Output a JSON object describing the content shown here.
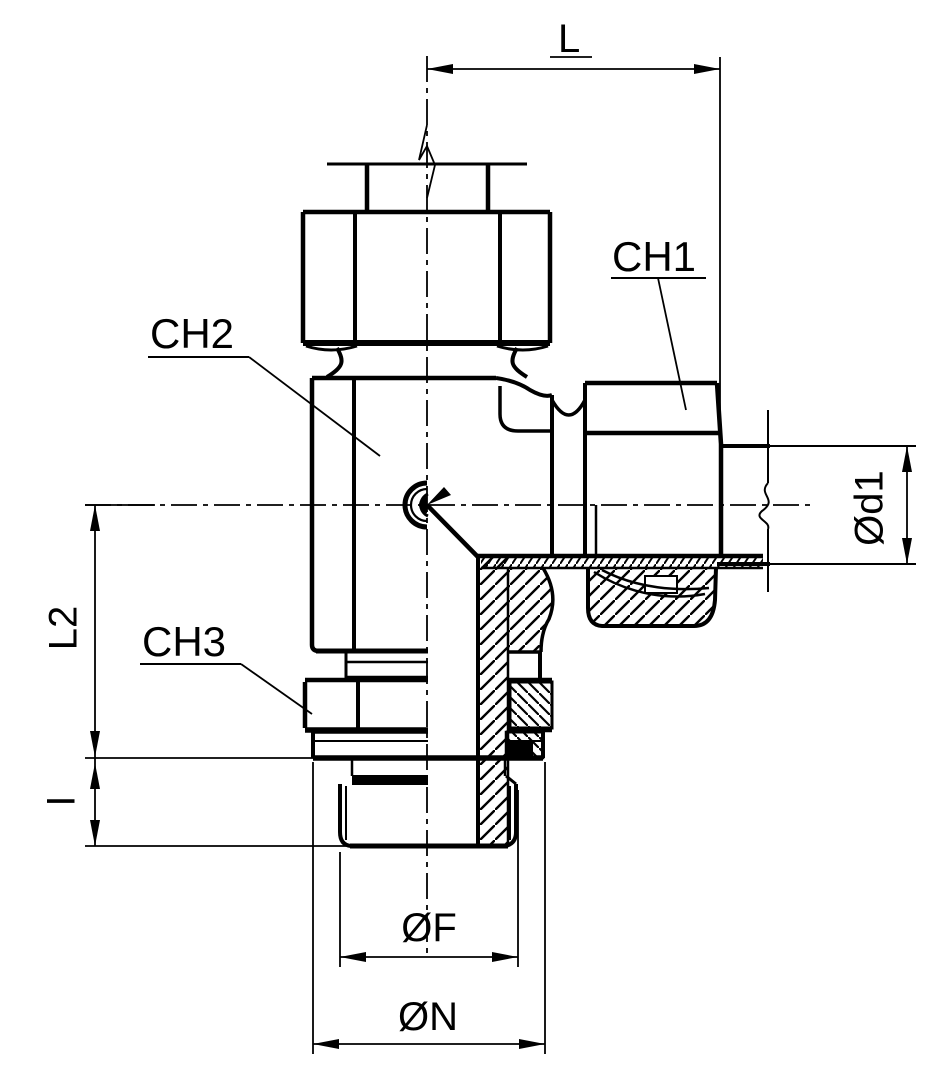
{
  "drawing": {
    "description_labels": {
      "length_top": "L",
      "wrench_flat_1": "CH1",
      "wrench_flat_2": "CH2",
      "wrench_flat_3": "CH3",
      "length_side": "L2",
      "thread_length": "I",
      "tube_diameter": "Ød1",
      "thread_diameter": "ØF",
      "washer_diameter": "ØN"
    },
    "colors": {
      "line": "#000000",
      "background": "#ffffff"
    }
  }
}
